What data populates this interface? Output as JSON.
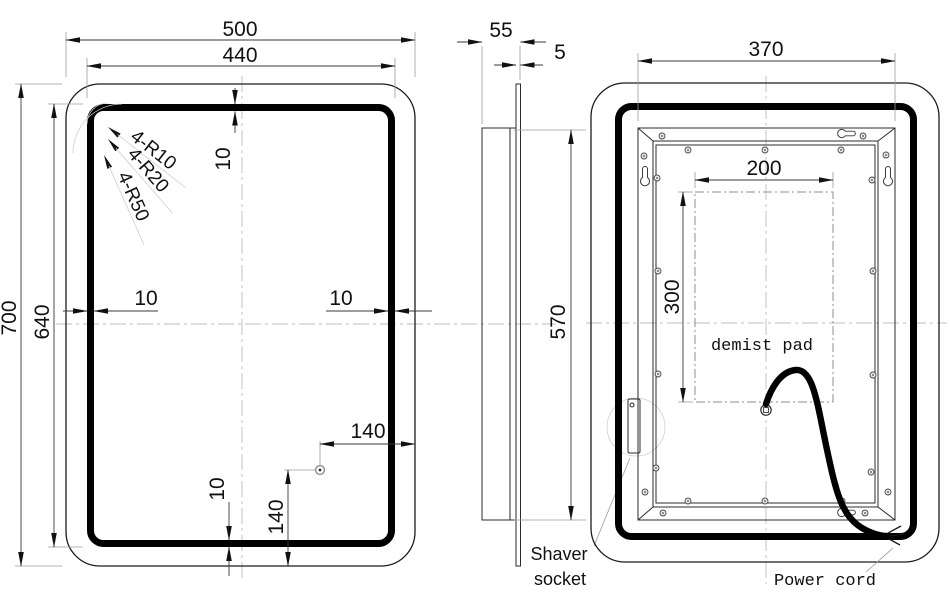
{
  "colors": {
    "background": "#ffffff",
    "outline": "#1c1c1c",
    "led_band": "#000000",
    "dimension_lines": "#3a3a3a",
    "auxiliary_lines": "#9b9b9b",
    "centerlines": "#bdbdbd"
  },
  "front_view": {
    "dim_width": "500",
    "dim_inner_width": "440",
    "dim_height": "700",
    "dim_inner_height": "640",
    "dim_band_top": "10",
    "dim_band_left": "10",
    "dim_band_right": "10",
    "dim_band_bottom": "10",
    "dim_sensor_from_right": "140",
    "dim_sensor_from_bottom": "140",
    "radius_label_r10": "4-R10",
    "radius_label_r20": "4-R20",
    "radius_label_r50": "4-R50"
  },
  "side_view": {
    "dim_depth": "55",
    "dim_glass_thickness": "5",
    "dim_box_height": "570",
    "shaver_label_line1": "Shaver",
    "shaver_label_line2": "socket"
  },
  "back_view": {
    "dim_frame_width": "370",
    "dim_pad_width": "200",
    "dim_pad_height": "300",
    "demist_pad_label": "demist pad",
    "power_cord_label": "Power cord"
  }
}
